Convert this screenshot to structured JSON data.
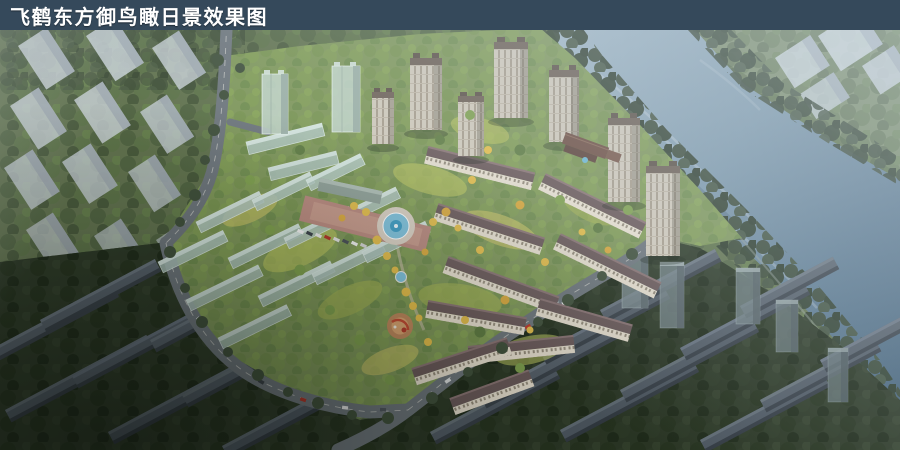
{
  "title_bar": {
    "text": "飞鹤东方御鸟瞰日景效果图",
    "background": "#35495B",
    "text_color": "#FFFFFF"
  },
  "scene": {
    "type": "aerial-architectural-rendering",
    "time_of_day": "day"
  },
  "palette": {
    "title_bar_bg": "#35495B",
    "river_blue": "#7C94A6",
    "site_green": "#7F975A",
    "bright_lawn": "#B9C35F",
    "tree_dark": "#3A4936",
    "tree_darkest": "#26331F",
    "tower_facade_tan": "#D0C9BA",
    "tower_roof_brown": "#6E6156",
    "row_roof_mauve": "#6B5A5A",
    "row_facade_cream": "#E7DFCF",
    "glass_massing": "#AEC4BD",
    "context_slab_gray": "#57616B",
    "white_massing": "#CDD5DA",
    "road_gray": "#6E767C",
    "plaza_pink": "#BE8D82",
    "fountain_blue": "#7FC2DC",
    "yellow_tree": "#E3BD4B",
    "playground_orange": "#C3885E",
    "car_red": "#B23528"
  }
}
